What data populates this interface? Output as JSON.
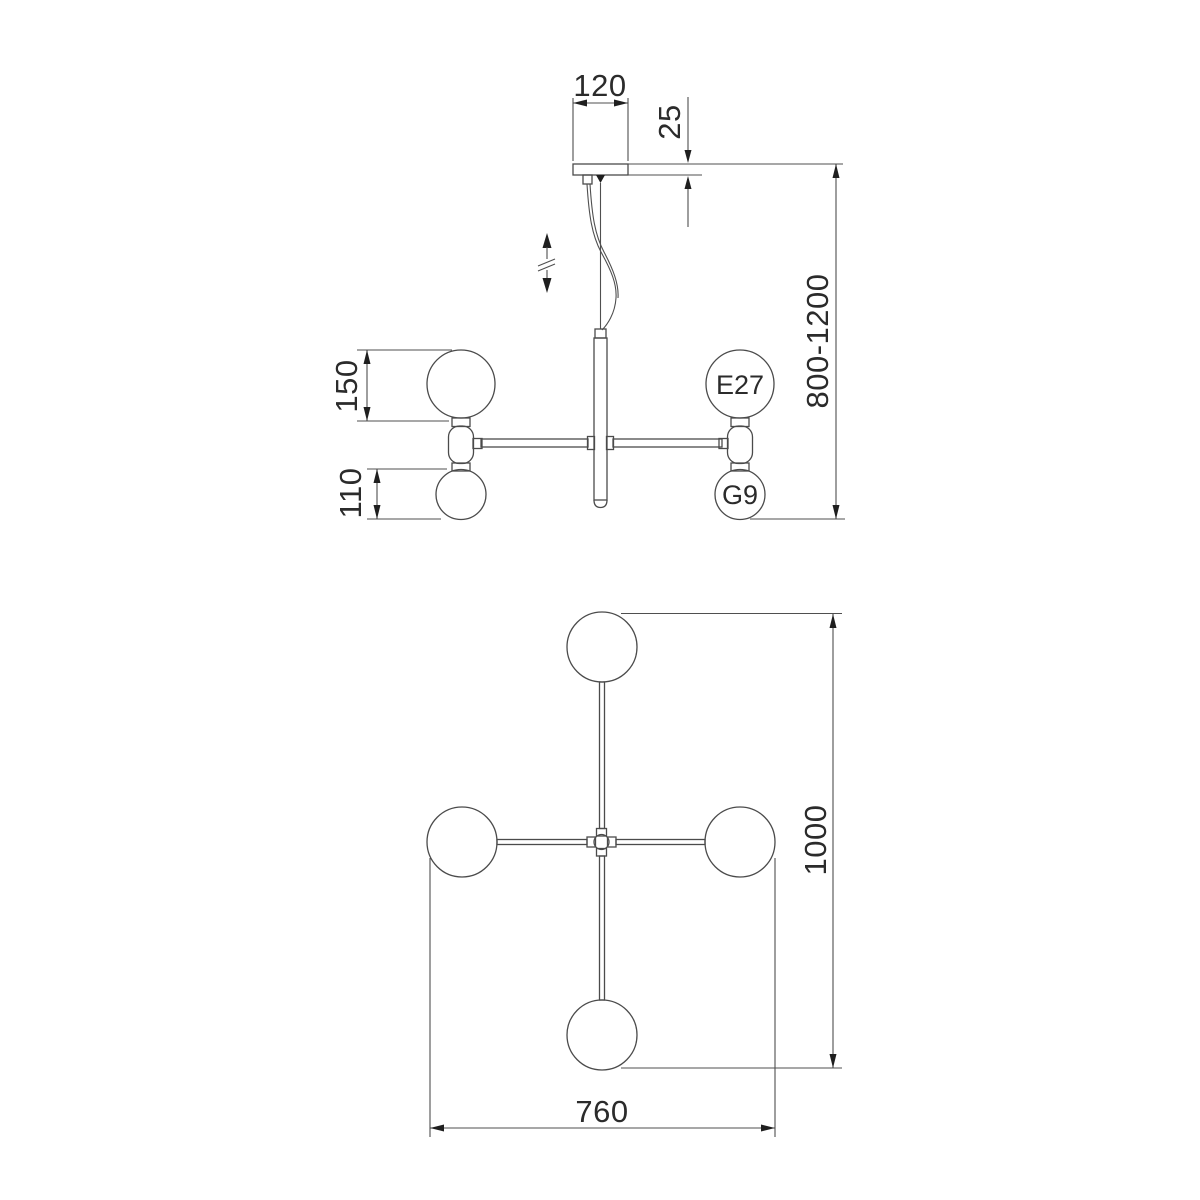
{
  "colors": {
    "line": "#4b4b4b",
    "arrow_and_text": "#1f1f1f",
    "background": "#ffffff"
  },
  "side_view": {
    "dim_canopy_width": "120",
    "dim_canopy_thickness": "25",
    "dim_suspension_height": "800-1200",
    "dim_large_shade_height": "150",
    "dim_small_shade_height": "110",
    "label_large_socket": "E27",
    "label_small_socket": "G9"
  },
  "top_view": {
    "dim_overall_depth": "1000",
    "dim_overall_width": "760"
  }
}
